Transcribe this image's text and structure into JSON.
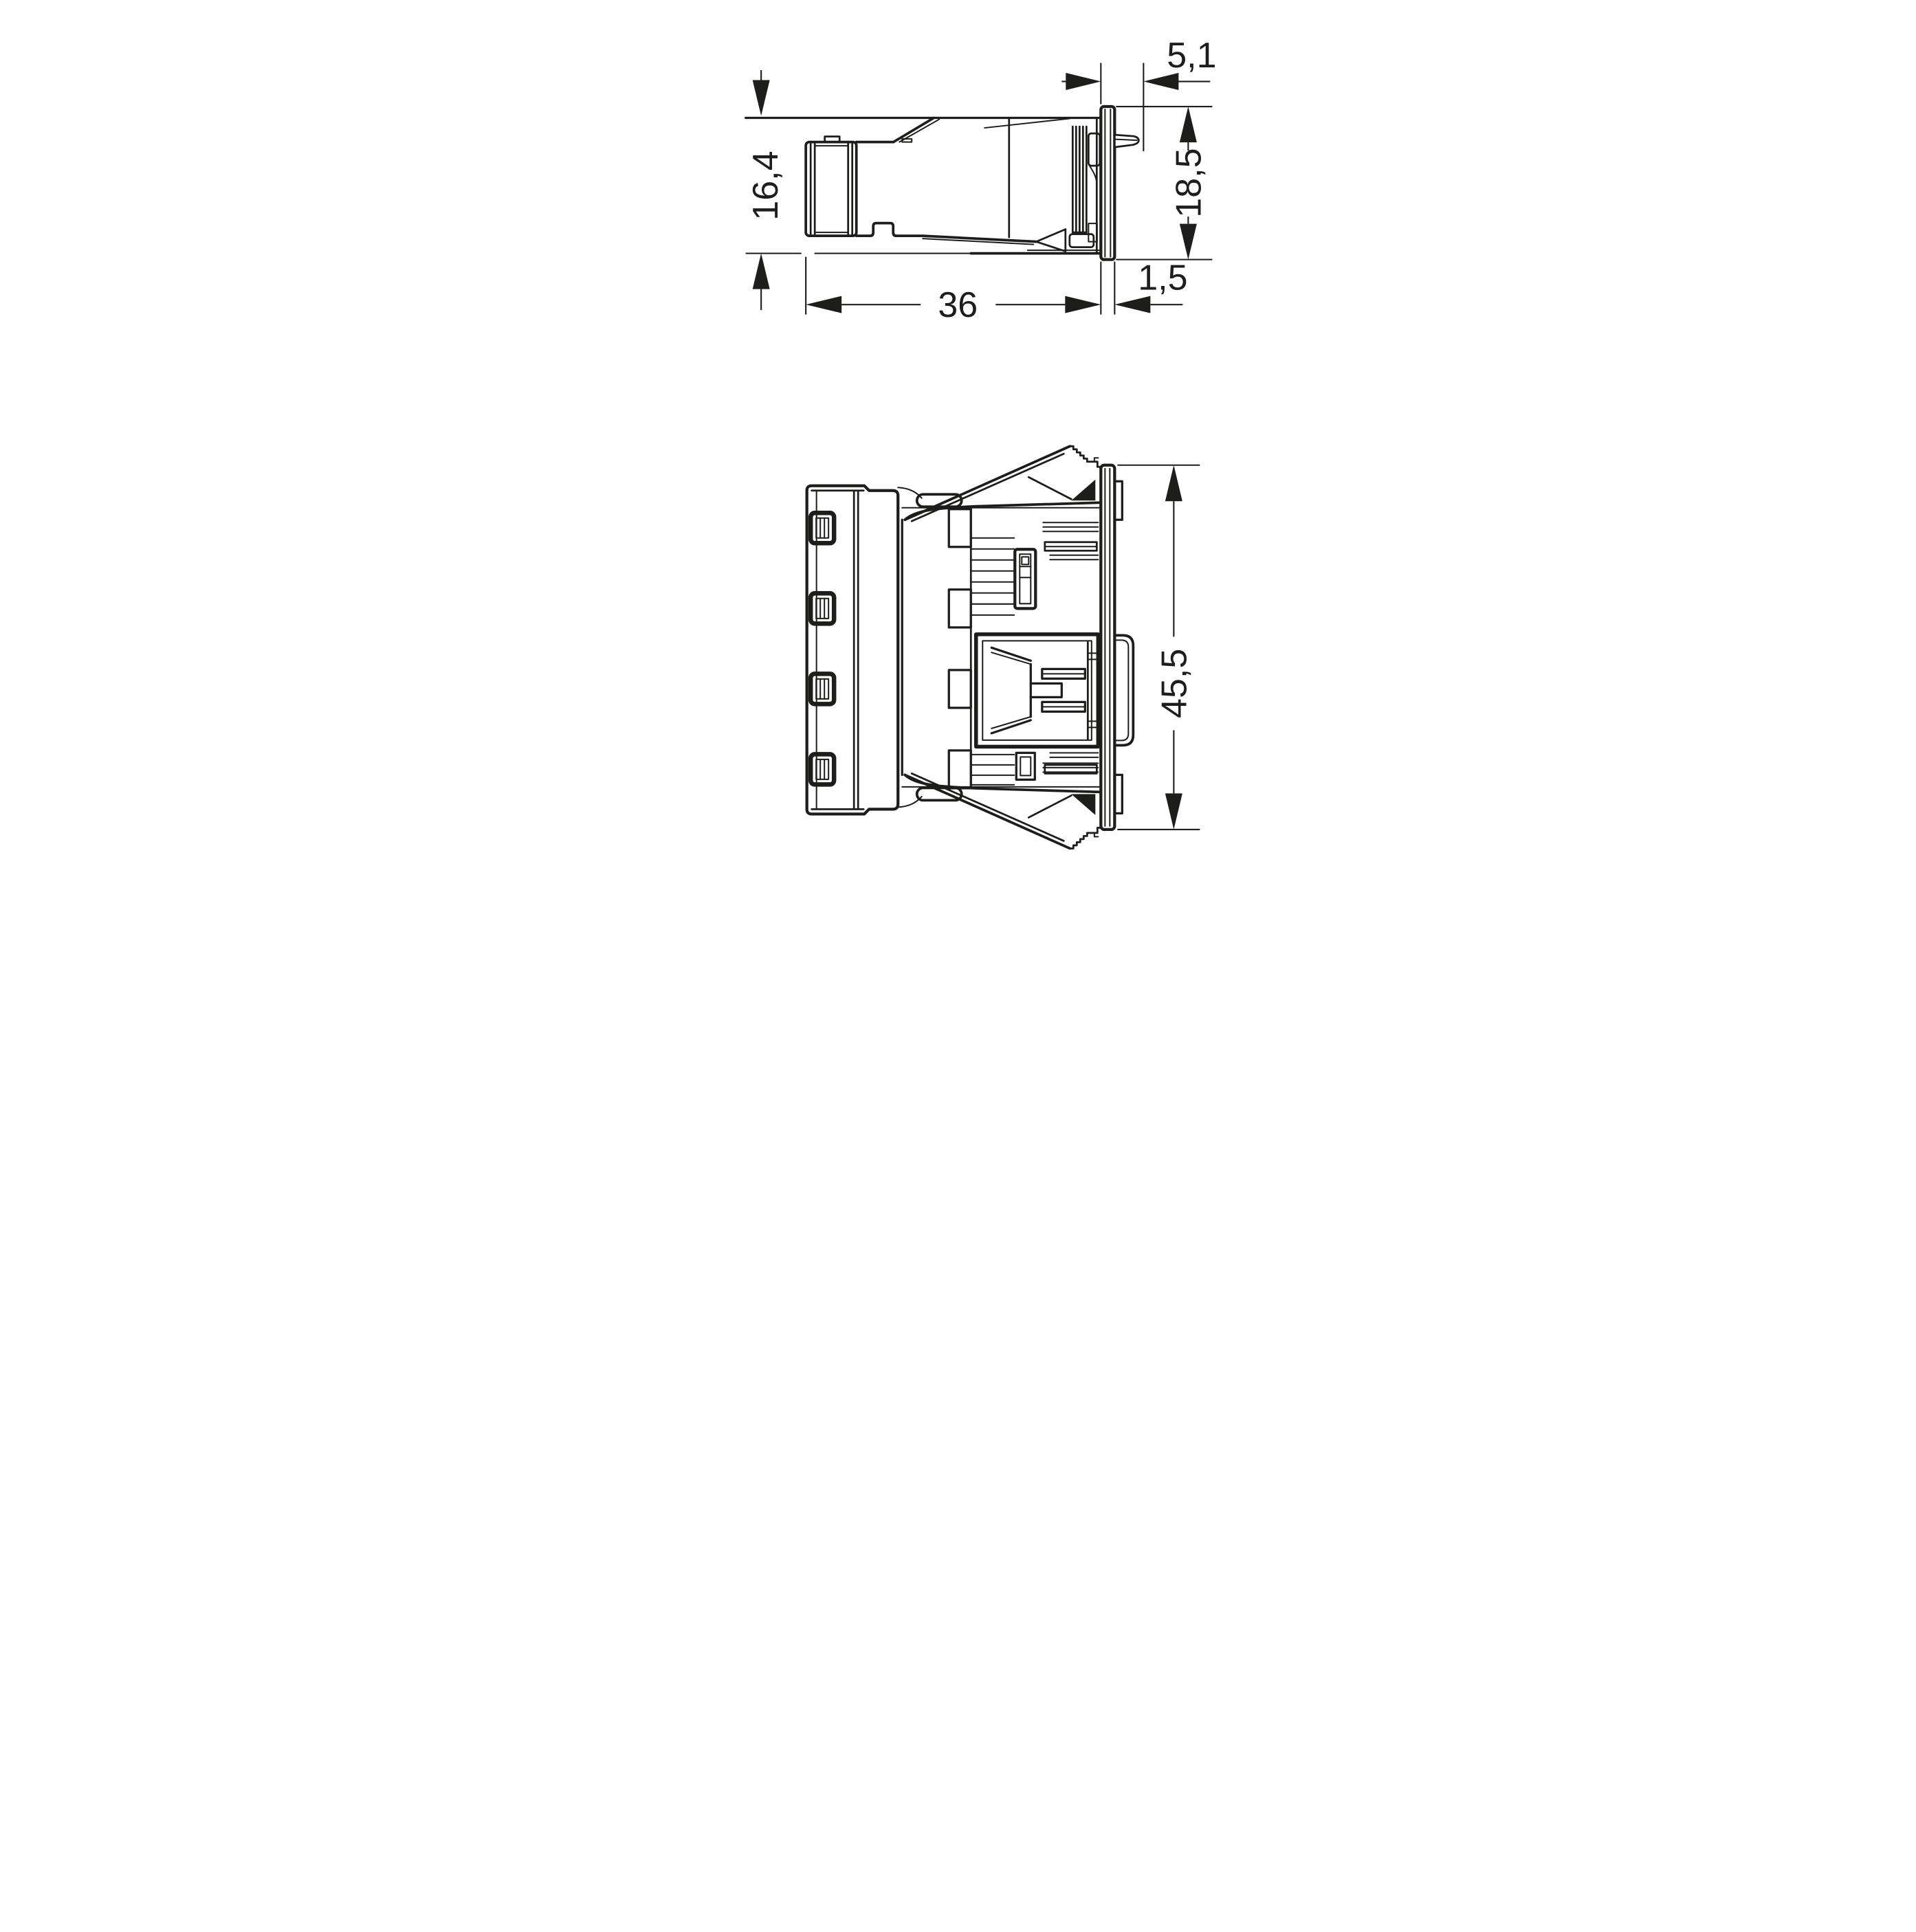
{
  "page": {
    "background": "#ffffff"
  },
  "drawing": {
    "line_color": "#1d1d1b",
    "side_view": {
      "dim_panel_depth": "5,1",
      "dim_body_height": "16,4",
      "dim_flange_height": "18,5",
      "dim_body_length": "36",
      "dim_flange_thickness": "1,5"
    },
    "front_view": {
      "dim_overall_height": "45,5"
    }
  }
}
